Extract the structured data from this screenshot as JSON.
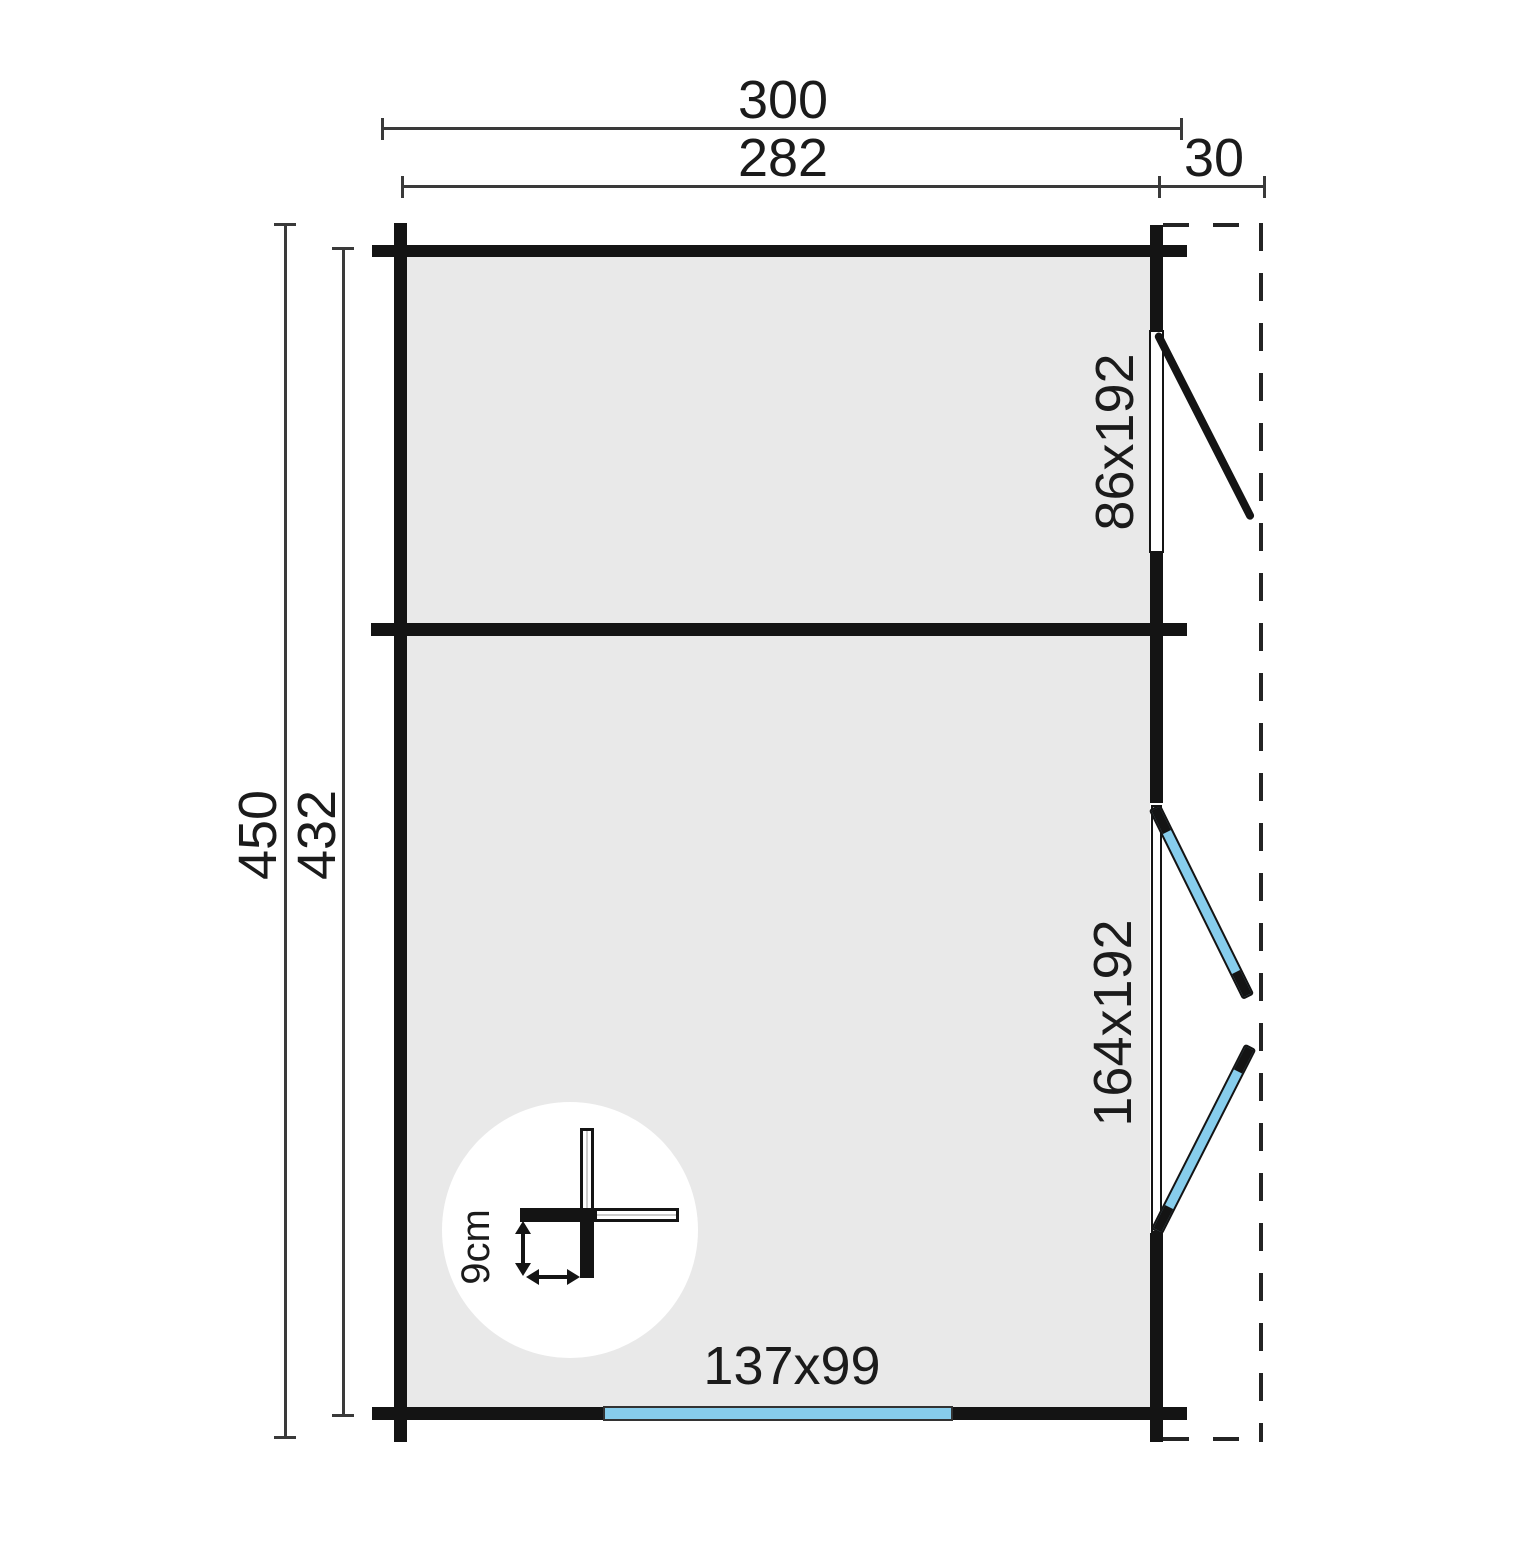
{
  "plan": {
    "dims": {
      "total_width": "300",
      "inner_width": "282",
      "overhang": "30",
      "total_depth": "450",
      "inner_depth": "432"
    },
    "openings": {
      "single_door": "86x192",
      "double_door": "164x192",
      "window": "137x99"
    },
    "detail": {
      "log_thickness": "9cm"
    },
    "colors": {
      "wall": "#141414",
      "interior_floor": "#e9e9e9",
      "glazing_blue": "#87cdec",
      "dimension_line": "#3a3a3a",
      "background": "#ffffff"
    }
  }
}
